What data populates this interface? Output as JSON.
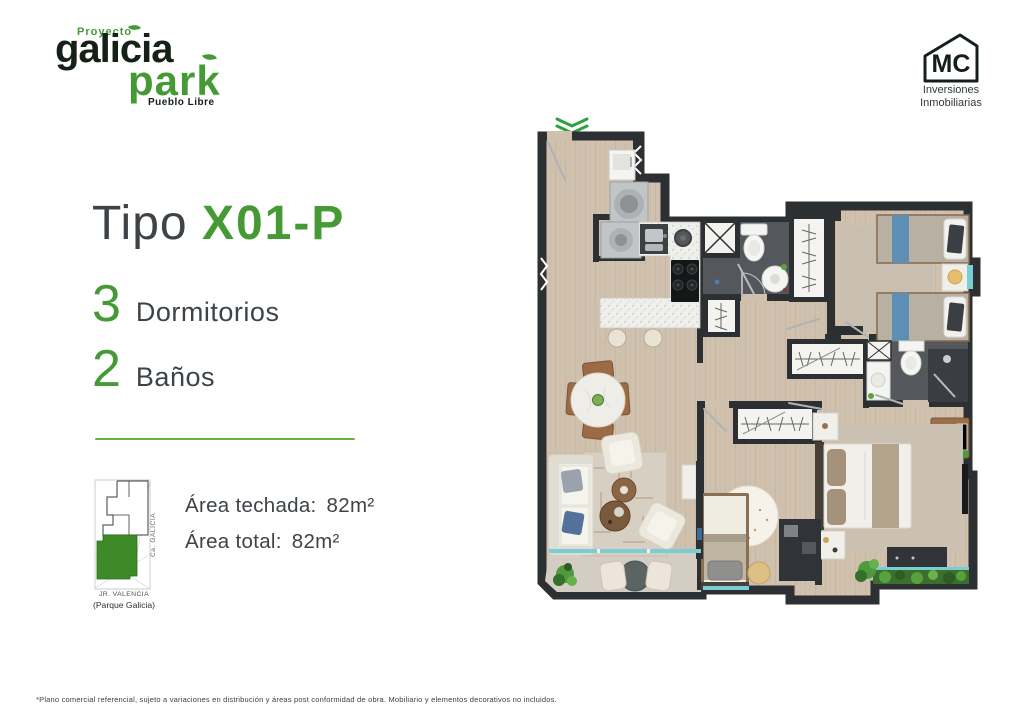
{
  "brand": {
    "project_label": "Proyecto",
    "name_top": "galicia",
    "name_bottom": "park",
    "district": "Pueblo Libre"
  },
  "developer": {
    "initials": "MC",
    "line1": "Inversiones",
    "line2": "Inmobiliarias"
  },
  "unit": {
    "type_label": "Tipo",
    "type_code": "X01-P",
    "features": [
      {
        "count": "3",
        "label": "Dormitorios"
      },
      {
        "count": "2",
        "label": "Baños"
      }
    ],
    "areas": [
      {
        "label": "Área techada:",
        "value": "82m²"
      },
      {
        "label": "Área total:",
        "value": "82m²"
      }
    ]
  },
  "map": {
    "street_side": "Ca. GALICIA",
    "street_front": "JR. VALENCIA",
    "street_front_note": "(Parque Galicia)"
  },
  "floorplan": {
    "entrance_marker": "double-chevron-down"
  },
  "footer": {
    "disclaimer": "*Plano comercial referencial, sujeto a variaciones en distribución y áreas post conformidad de obra. Mobiliario y elementos decorativos no incluidos."
  },
  "colors": {
    "brand_green": "#469a35",
    "logo_dark": "#152018",
    "text_dark": "#3d4347",
    "divider_green": "#68af4a",
    "map_highlight": "#3e8a28",
    "plan_wall": "#2d3032",
    "plan_wood": "#cfc1ad",
    "plan_bath_floor": "#54575b",
    "plan_balcony_floor": "#d3cdc3",
    "plan_glass": "#7acdd3",
    "plan_bed_blue": "#5d8fb5",
    "plan_plant_green": "#4f9a3d"
  }
}
